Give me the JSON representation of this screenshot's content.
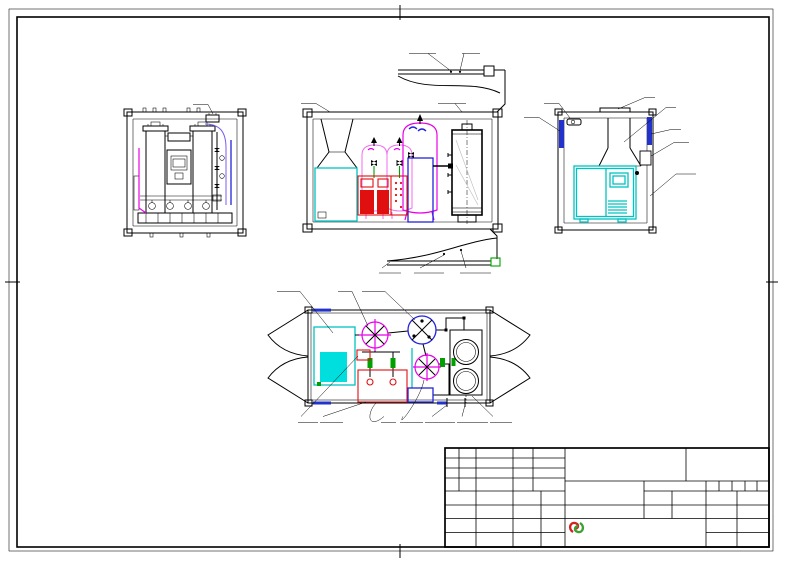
{
  "title_block": {
    "product_title": "PSA集装箱式制氮机",
    "code_value": "-",
    "drawing_no_label": "图号:",
    "drawing_no_value": "-",
    "rev_cols": [
      "标记",
      "处数",
      "更改文件号",
      "签 字",
      "日期"
    ],
    "rows": {
      "design": "设 计",
      "draft": "制 图",
      "check": "审 核",
      "process": "工 艺",
      "standard": "标准化",
      "approve": "审 定",
      "date": "日 期"
    },
    "mark_header": "图 样 标 记",
    "material_label": "材 料",
    "material_value": "-",
    "surface_label": "表面处理",
    "surface_value": "-",
    "weight_label": "重 量",
    "weight_value": "-",
    "quantity_label": "数 量",
    "quantity_value": "-",
    "scale_label": "比 例",
    "scale_value": "-",
    "total_sheets_label": "共  张",
    "sheet_no_label": "第  张",
    "company_cn": "怀来华晶气分化工设备有限公司",
    "company_en": "Huailai huachang Gas separated Chemical and industry equipment Co.,Ltd"
  },
  "labels": {
    "left_view": {
      "muffler": "消声器"
    },
    "side_view": {
      "vent": "通风口",
      "sieve_port": "分子筛装卸口",
      "ext_power": "外部电源接口",
      "reserved_port": "预留接口",
      "drain": "排污口(G1)",
      "n2_outlet": "氮气出口(G3/4)",
      "air_inlet": "空气进口(1NPT)"
    },
    "right_view": {
      "lamp": "照明灯",
      "louver": "进风口",
      "roof": "顶盖",
      "duct": "风道",
      "hinge": "铰链",
      "power_box": "电源箱",
      "protect_line1": "空压机电源线",
      "protect_line2": "保护管"
    },
    "plan_view": {
      "compressor": "螺杆空压机",
      "air_tank": "储气罐",
      "n2_buffer": "氮气缓冲罐",
      "lv_power": "低压(24V)",
      "wiring_box": "电气控制箱",
      "control_box": "电控箱",
      "air_buffer": "空气缓冲罐",
      "n2_outlet": "氮气出口(G3/4)",
      "air_inlet": "空气进口(1NPT)",
      "psa": "PSA制氮机"
    }
  },
  "colors": {
    "line": "#000000",
    "magenta": "#e800e8",
    "red": "#e01010",
    "blue": "#2222dd",
    "cyan": "#00c2c2",
    "green": "#00a000",
    "company_red": "#7a4038"
  }
}
